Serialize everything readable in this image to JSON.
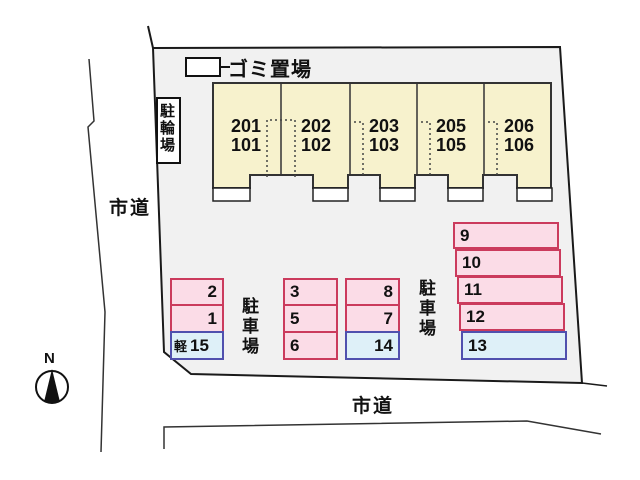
{
  "labels": {
    "garbage": "ゴミ置場",
    "bicycle": "駐輪場",
    "road_left": "市道",
    "road_bottom": "市道",
    "compass_north": "N"
  },
  "building": {
    "units": [
      {
        "upper": "201",
        "lower": "101"
      },
      {
        "upper": "202",
        "lower": "102"
      },
      {
        "upper": "203",
        "lower": "103"
      },
      {
        "upper": "205",
        "lower": "105"
      },
      {
        "upper": "206",
        "lower": "106"
      }
    ]
  },
  "parking": {
    "left_label": "駐車場",
    "right_label": "駐車場",
    "col1": [
      {
        "num": "2",
        "type": "pink"
      },
      {
        "num": "1",
        "type": "pink"
      },
      {
        "num": "15",
        "prefix": "軽",
        "type": "blue"
      }
    ],
    "col2": [
      {
        "num": "3",
        "type": "pink"
      },
      {
        "num": "5",
        "type": "pink"
      },
      {
        "num": "6",
        "type": "pink"
      }
    ],
    "col3": [
      {
        "num": "8",
        "type": "pink"
      },
      {
        "num": "7",
        "type": "pink"
      },
      {
        "num": "14",
        "type": "blue"
      }
    ],
    "col4": [
      {
        "num": "9",
        "type": "pink"
      },
      {
        "num": "10",
        "type": "pink"
      },
      {
        "num": "11",
        "type": "pink"
      },
      {
        "num": "12",
        "type": "pink"
      },
      {
        "num": "13",
        "type": "blue"
      }
    ]
  },
  "colors": {
    "site_fill": "#f1f1f1",
    "building_fill": "#f7f2cd",
    "pink_fill": "#fbdce7",
    "pink_border": "#cb3b5d",
    "blue_fill": "#def0f8",
    "blue_border": "#5050ae"
  }
}
